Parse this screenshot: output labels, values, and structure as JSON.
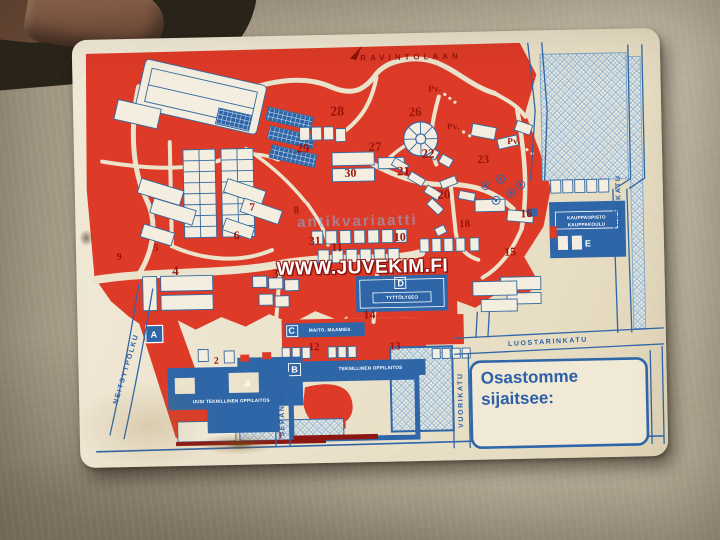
{
  "photo": {
    "surface_color": "#b2a792",
    "finger_skin_color": "#8c614a",
    "corner_shadow_color": "#2b241b"
  },
  "card": {
    "colors": {
      "paper": "#ece3cd",
      "map_red": "#de3a28",
      "map_blue": "#2f66a8",
      "hatch_blue": "#96b9d6",
      "number_red": "#9c130a",
      "dark_red": "#8c1710"
    },
    "watermark_small": "antikvariaatti",
    "watermark_large": "WWW.JUVEKIM.FI",
    "top_route_label": "RAVINTOLAAN",
    "pv_label": "Pv.",
    "legend": {
      "line1": "Osastomme",
      "line2": "sijaitsee:"
    },
    "streets": [
      {
        "name": "KASKENKATU",
        "x": 544,
        "y": 178,
        "rot": -90
      },
      {
        "name": "LUOSTARINKATU",
        "x": 470,
        "y": 312,
        "rot": -2
      },
      {
        "name": "VUORIKATU",
        "x": 382,
        "y": 368,
        "rot": -90
      },
      {
        "name": "SEPÄNKATU",
        "x": 203,
        "y": 372,
        "rot": -90
      },
      {
        "name": "NEITSYTPOLKU",
        "x": 48,
        "y": 330,
        "rot": -72
      }
    ],
    "pv_markers": [
      {
        "x": 362,
        "y": 56
      },
      {
        "x": 380,
        "y": 94
      },
      {
        "x": 440,
        "y": 110
      }
    ],
    "numbers": [
      {
        "n": "1",
        "x": 200,
        "y": 400,
        "s": 10
      },
      {
        "n": "2",
        "x": 138,
        "y": 324,
        "s": 10
      },
      {
        "n": "3",
        "x": 199,
        "y": 238,
        "s": 12
      },
      {
        "n": "4",
        "x": 99,
        "y": 233,
        "s": 13
      },
      {
        "n": "5",
        "x": 80,
        "y": 210,
        "s": 10
      },
      {
        "n": "6",
        "x": 161,
        "y": 199,
        "s": 12
      },
      {
        "n": "7",
        "x": 177,
        "y": 171,
        "s": 11
      },
      {
        "n": "8",
        "x": 221,
        "y": 175,
        "s": 11
      },
      {
        "n": "9",
        "x": 43,
        "y": 218,
        "s": 10
      },
      {
        "n": "10",
        "x": 324,
        "y": 204,
        "s": 12
      },
      {
        "n": "11",
        "x": 261,
        "y": 213,
        "s": 12
      },
      {
        "n": "12",
        "x": 236,
        "y": 312,
        "s": 11
      },
      {
        "n": "13",
        "x": 317,
        "y": 313,
        "s": 11
      },
      {
        "n": "14",
        "x": 292,
        "y": 281,
        "s": 12
      },
      {
        "n": "15",
        "x": 434,
        "y": 221,
        "s": 12
      },
      {
        "n": "16",
        "x": 451,
        "y": 183,
        "s": 12
      },
      {
        "n": "18",
        "x": 389,
        "y": 192,
        "s": 11
      },
      {
        "n": "20",
        "x": 369,
        "y": 162,
        "s": 13
      },
      {
        "n": "21",
        "x": 329,
        "y": 138,
        "s": 13
      },
      {
        "n": "22",
        "x": 354,
        "y": 121,
        "s": 13
      },
      {
        "n": "23",
        "x": 409,
        "y": 128,
        "s": 12
      },
      {
        "n": "26",
        "x": 342,
        "y": 79,
        "s": 13
      },
      {
        "n": "27",
        "x": 301,
        "y": 113,
        "s": 13
      },
      {
        "n": "28",
        "x": 264,
        "y": 78,
        "s": 14
      },
      {
        "n": "29",
        "x": 229,
        "y": 113,
        "s": 13
      },
      {
        "n": "30",
        "x": 276,
        "y": 139,
        "s": 12
      },
      {
        "n": "31",
        "x": 239,
        "y": 206,
        "s": 12
      }
    ],
    "letters": [
      {
        "ch": "A",
        "x": 76,
        "y": 296
      },
      {
        "ch": "A",
        "x": 169,
        "y": 347
      },
      {
        "ch": "B",
        "x": 216,
        "y": 334
      },
      {
        "ch": "C",
        "x": 214,
        "y": 295
      },
      {
        "ch": "D",
        "x": 324,
        "y": 250
      },
      {
        "ch": "E",
        "x": 512,
        "y": 214
      }
    ],
    "building_labels": [
      {
        "text": "UUSI TEKNILLINEN OPPILAITOS",
        "x": 152,
        "y": 364
      },
      {
        "text": "TEKNILLINEN OPPILAITOS",
        "x": 292,
        "y": 334
      },
      {
        "text": "MAITO. MAAMIES",
        "x": 252,
        "y": 295
      },
      {
        "text": "TYTTÖLYSEO",
        "x": 325,
        "y": 264
      },
      {
        "text": "KAUPPAOPISTO",
        "x": 511,
        "y": 188
      },
      {
        "text": "KAUPPAKOULU",
        "x": 511,
        "y": 195
      }
    ]
  }
}
